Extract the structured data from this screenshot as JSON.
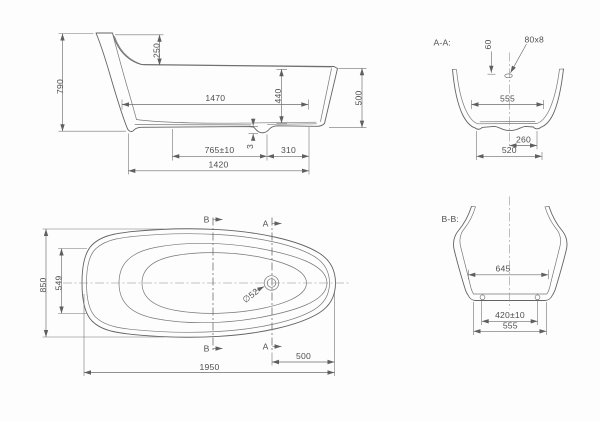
{
  "title": "bathtub-technical-drawing",
  "side_view": {
    "overall_height": "790",
    "backrest_drop": "250",
    "inner_length": "1470",
    "inner_depth": "440",
    "foot_end_height": "500",
    "support_front": "765±10",
    "recess_depth": "3",
    "support_rear": "310",
    "base_length": "1420"
  },
  "plan_view": {
    "section_b_label": "B",
    "section_a_label": "A",
    "overall_width": "850",
    "inner_width": "549",
    "drain_diameter": "∅52",
    "drain_to_end": "500",
    "overall_length": "1950"
  },
  "section_aa": {
    "title": "A-A:",
    "overflow_offset": "60",
    "overflow_slot": "80x8",
    "inner_width": "555",
    "drain_offset": "260",
    "base_width": "520"
  },
  "section_bb": {
    "title": "B-B:",
    "inner_width": "645",
    "support_span": "420±10",
    "base_width": "555"
  },
  "colors": {
    "line": "#636363",
    "dimension": "#6b6b6b",
    "text": "#4f4f4f",
    "background": "#fdfdfd"
  }
}
